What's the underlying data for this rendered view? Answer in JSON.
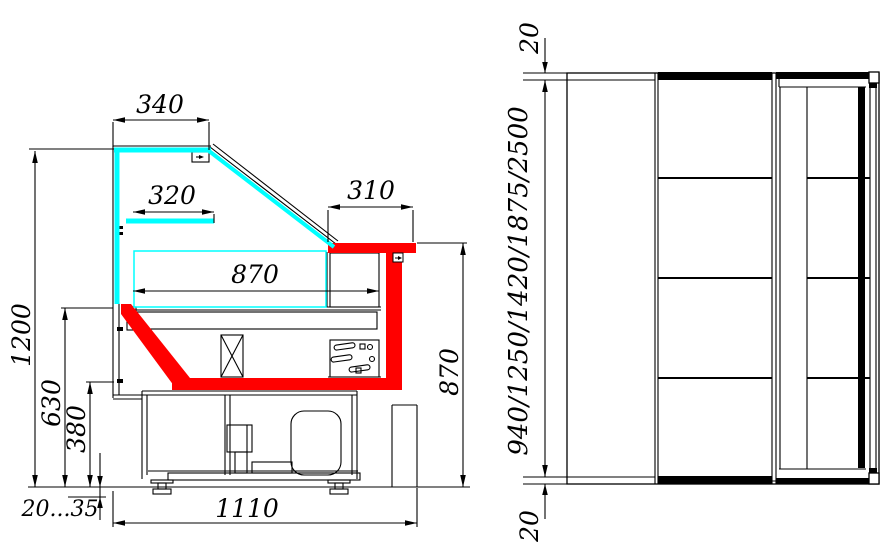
{
  "colors": {
    "glass_highlight": "#00ffff",
    "profile_highlight": "#ff0000",
    "line": "#000000",
    "background": "#ffffff"
  },
  "side_view": {
    "dim_top_glass_depth": "340",
    "dim_shelf_depth": "320",
    "dim_counter_depth": "310",
    "dim_display_depth": "870",
    "dim_overall_height": "1200",
    "dim_glass_sill_height": "630",
    "dim_base_section_height": "380",
    "dim_foot_adjustment": "20...35",
    "dim_overall_depth": "1110",
    "dim_counter_height": "870"
  },
  "top_view": {
    "dim_end_overhang_top": "20",
    "dim_case_lengths": "940/1250/1420/1875/2500",
    "dim_end_overhang_bottom": "20"
  }
}
